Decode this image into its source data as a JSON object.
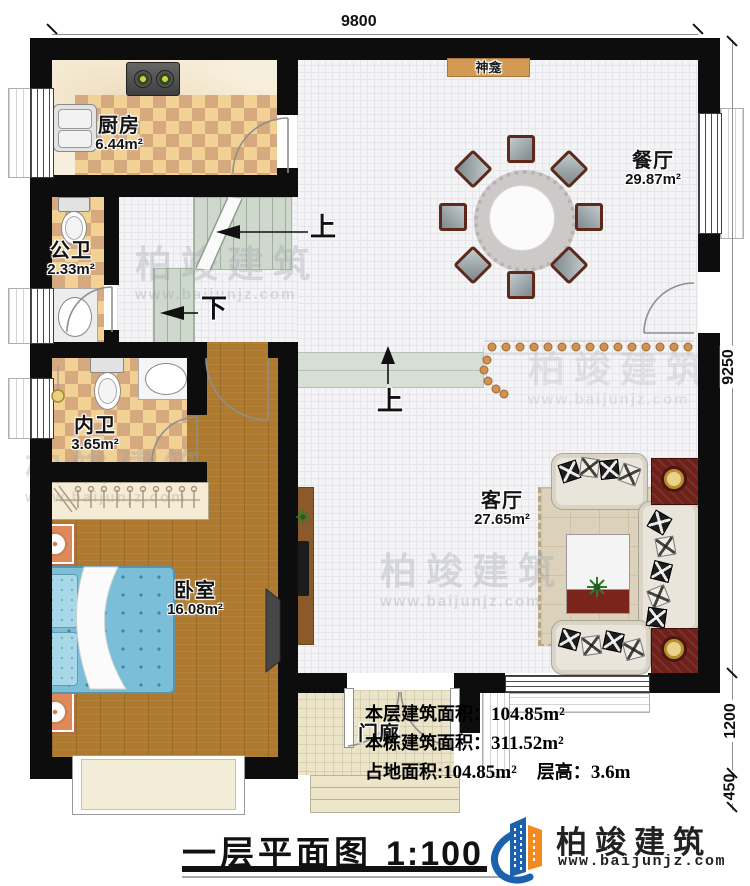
{
  "plan": {
    "dimensions": {
      "top": "9800",
      "right": "9250",
      "right_mid": "1200",
      "right_bottom": "450"
    },
    "rooms": {
      "kitchen": {
        "name": "厨房",
        "area": "6.44m²"
      },
      "public_bath": {
        "name": "公卫",
        "area": "2.33m²"
      },
      "inner_bath": {
        "name": "内卫",
        "area": "3.65m²"
      },
      "bedroom": {
        "name": "卧室",
        "area": "16.08m²"
      },
      "dining": {
        "name": "餐厅",
        "area": "29.87m²"
      },
      "living": {
        "name": "客厅",
        "area": "27.65m²"
      },
      "porch": {
        "name": "门廊"
      }
    },
    "features": {
      "shrine": "神龛",
      "stairs_up": "上",
      "stairs_down": "下",
      "entry_step_up": "上"
    },
    "info": {
      "line1_label": "本层建筑面积：",
      "line1_value": "104.85m²",
      "line2_label": "本栋建筑面积：",
      "line2_value": "311.52m²",
      "line3_label": "占地面积:",
      "line3_value": "104.85m²",
      "line3_label2": "层高：",
      "line3_value2": "3.6m"
    },
    "title": {
      "text": "一层平面图",
      "scale": "1:100"
    },
    "branding": {
      "company": "柏竣建筑",
      "website": "www.baijunjz.com",
      "logo_blue": "#1b61ad",
      "logo_orange": "#f28a1e"
    },
    "watermark": {
      "text": "柏竣建筑",
      "url": "www.baijunjz.com"
    }
  }
}
